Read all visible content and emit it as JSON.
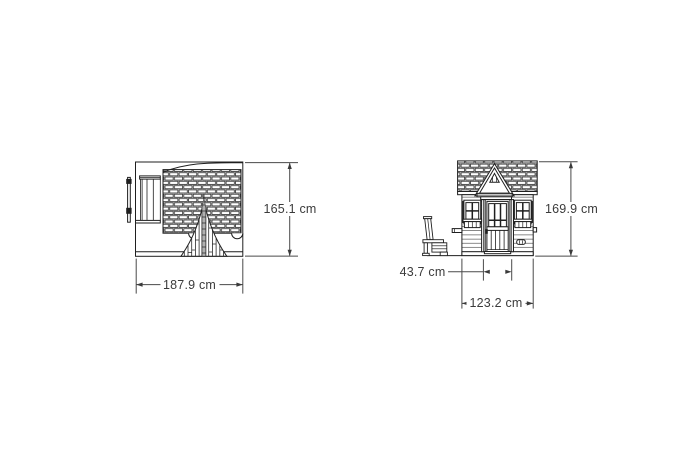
{
  "diagram": {
    "subject": "playhouse-dimension-drawing",
    "views": [
      {
        "id": "side-view",
        "dimensions": [
          {
            "name": "overall-height",
            "label": "165.1 cm"
          },
          {
            "name": "overall-depth",
            "label": "187.9 cm"
          }
        ]
      },
      {
        "id": "front-view",
        "dimensions": [
          {
            "name": "overall-height",
            "label": "169.9 cm"
          },
          {
            "name": "door-width",
            "label": "43.7 cm"
          },
          {
            "name": "overall-width",
            "label": "123.2 cm"
          }
        ]
      }
    ],
    "colors": {
      "background": "#ffffff",
      "drawing_line": "#1f1f1f",
      "dimension_line": "#4a4a4a",
      "label_text": "#3b3b3b",
      "shutter_fill": "#2b2b2b",
      "door_pole_fill": "#b0b0b0"
    }
  }
}
